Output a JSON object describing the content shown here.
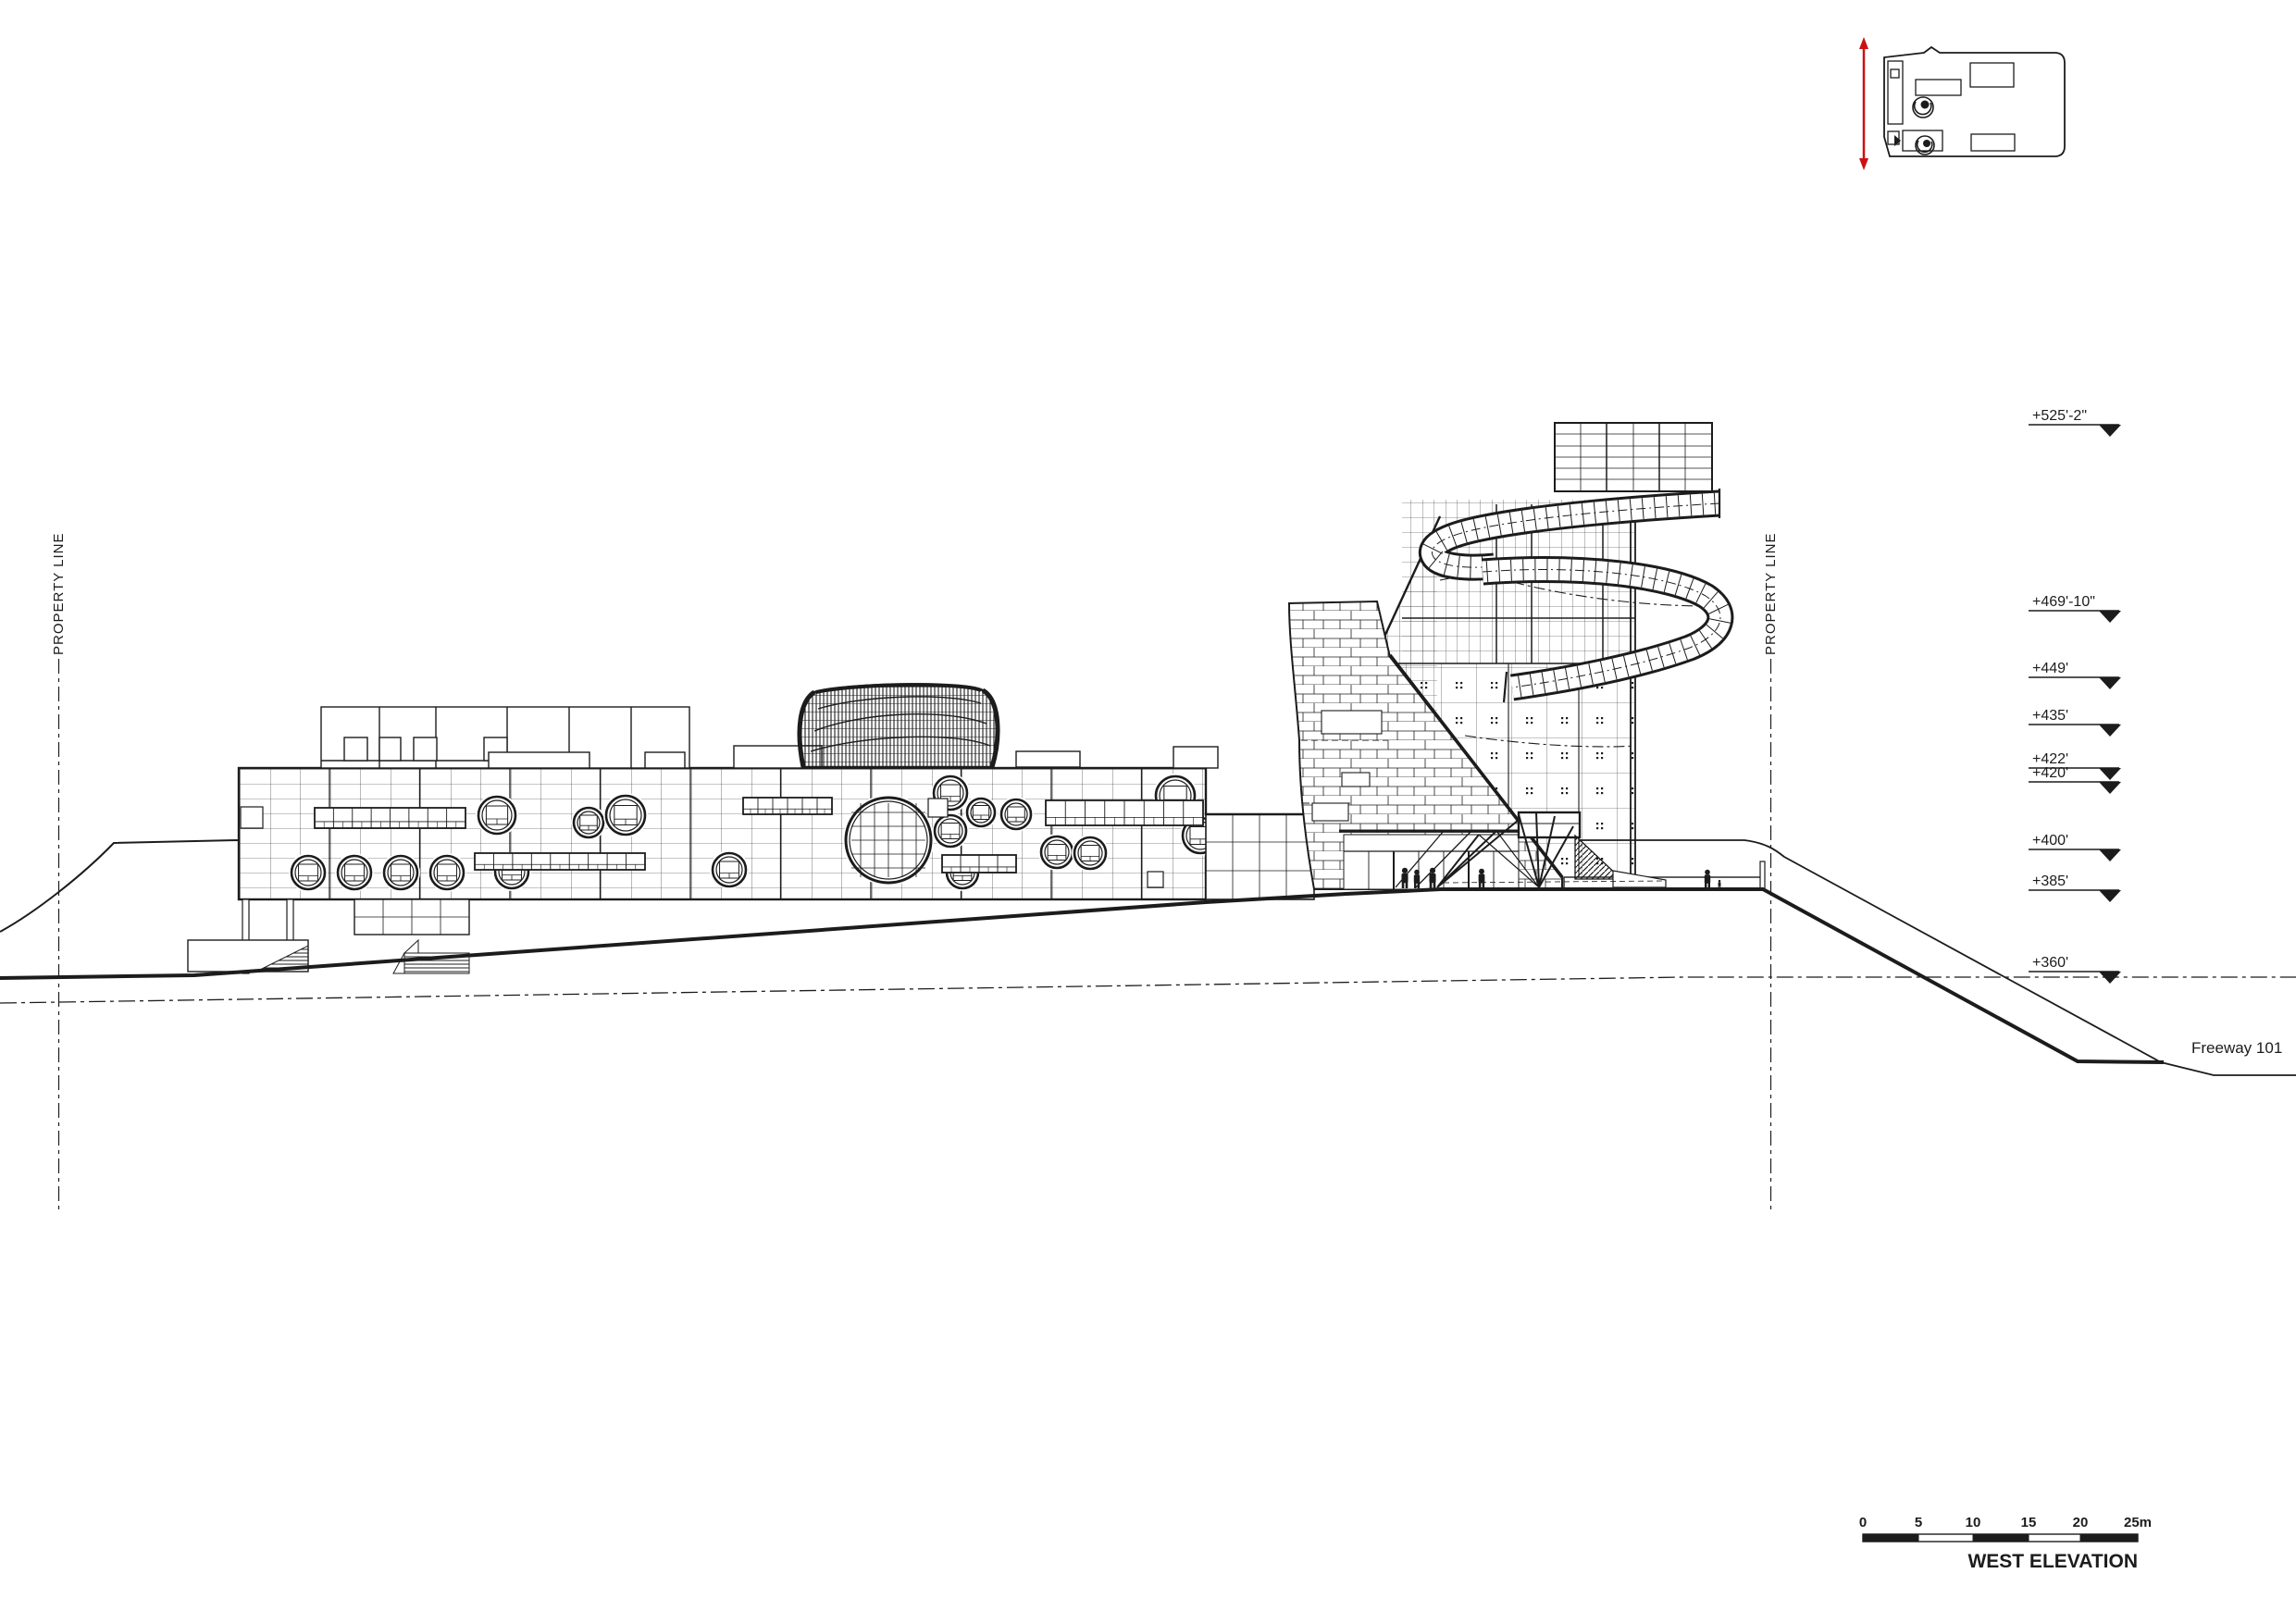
{
  "drawing": {
    "title": "WEST ELEVATION",
    "freeway_label": "Freeway 101",
    "property_line_left": "PROPERTY LINE",
    "property_line_right": "PROPERTY LINE",
    "elevation_markers": [
      "+525'-2\"",
      "+469'-10\"",
      "+449'",
      "+435'",
      "+422'",
      "+420'",
      "+400'",
      "+385'",
      "+360'"
    ],
    "scale_bar_ticks": [
      "0",
      "5",
      "10",
      "15",
      "20",
      "25m"
    ],
    "colors": {
      "ink": "#1c1c1c",
      "section_marker": "#cc1111",
      "background": "#ffffff"
    }
  }
}
